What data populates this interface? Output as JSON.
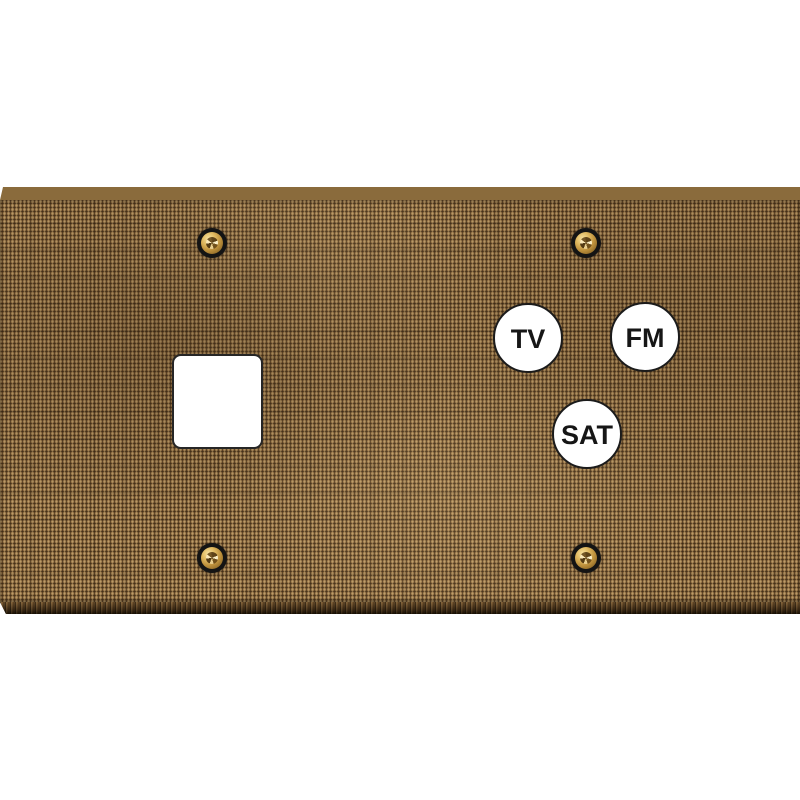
{
  "scene": {
    "description": "Product photo of a two-gang wall plate with woven bronze fabric finish, one keystone square cutout, three coax antenna ports and four brass screws",
    "background_color": "#ffffff"
  },
  "plate": {
    "finish": "woven-fabric-bronze",
    "base_color": "#8d6b41",
    "thread_light_color": "#c9a368",
    "gap_dark_color": "#362410",
    "top_bevel_color": "#8a6b3c",
    "bottom_bevel_color": "#3a2812"
  },
  "cutout": {
    "type": "keystone-square-opening",
    "fill_color": "#ffffff",
    "border_color": "#262626"
  },
  "screws": {
    "count": 4,
    "finish": "brass",
    "ring_color": "#141414",
    "head_color": "#c0933e"
  },
  "ports": [
    {
      "label": "TV"
    },
    {
      "label": "FM"
    },
    {
      "label": "SAT"
    }
  ],
  "port_style": {
    "fill_color": "#ffffff",
    "border_color": "#1b1b1b",
    "text_color": "#161616"
  }
}
